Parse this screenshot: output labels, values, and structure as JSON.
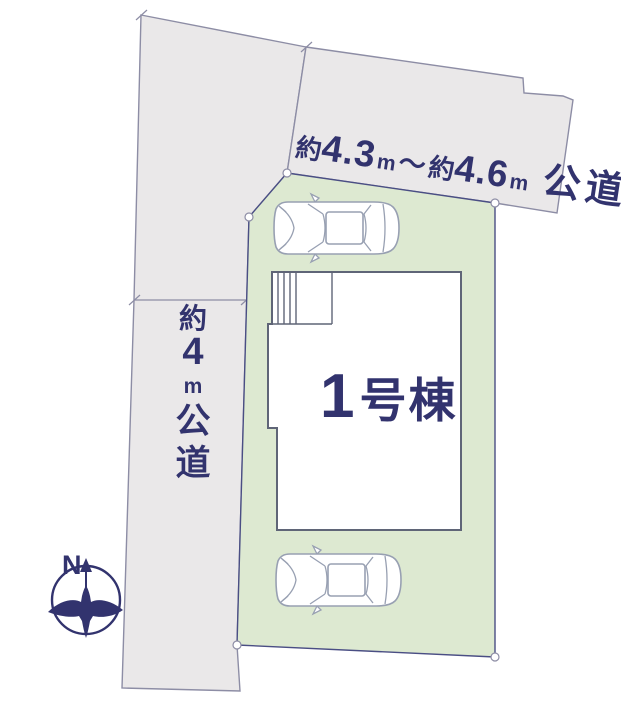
{
  "colors": {
    "background": "#ffffff",
    "road_fill": "#eae8e9",
    "plot_fill": "#dde9d1",
    "navy": "#32336e",
    "boundary_gray": "#8d8da5",
    "plot_line": "#4a4e84",
    "building_line": "#5f6577",
    "car_line": "#98a0b2"
  },
  "roads": {
    "top": {
      "approx1": "約",
      "width1": "4.3",
      "unit1": "m",
      "tilde": "～",
      "approx2": "約",
      "width2": "4.6",
      "unit2": "m",
      "type": "公道"
    },
    "left": {
      "chars": [
        "約",
        "4",
        "m",
        "公",
        "道"
      ]
    }
  },
  "building": {
    "number": "1",
    "label": "号棟"
  },
  "compass": {
    "north": "N"
  }
}
